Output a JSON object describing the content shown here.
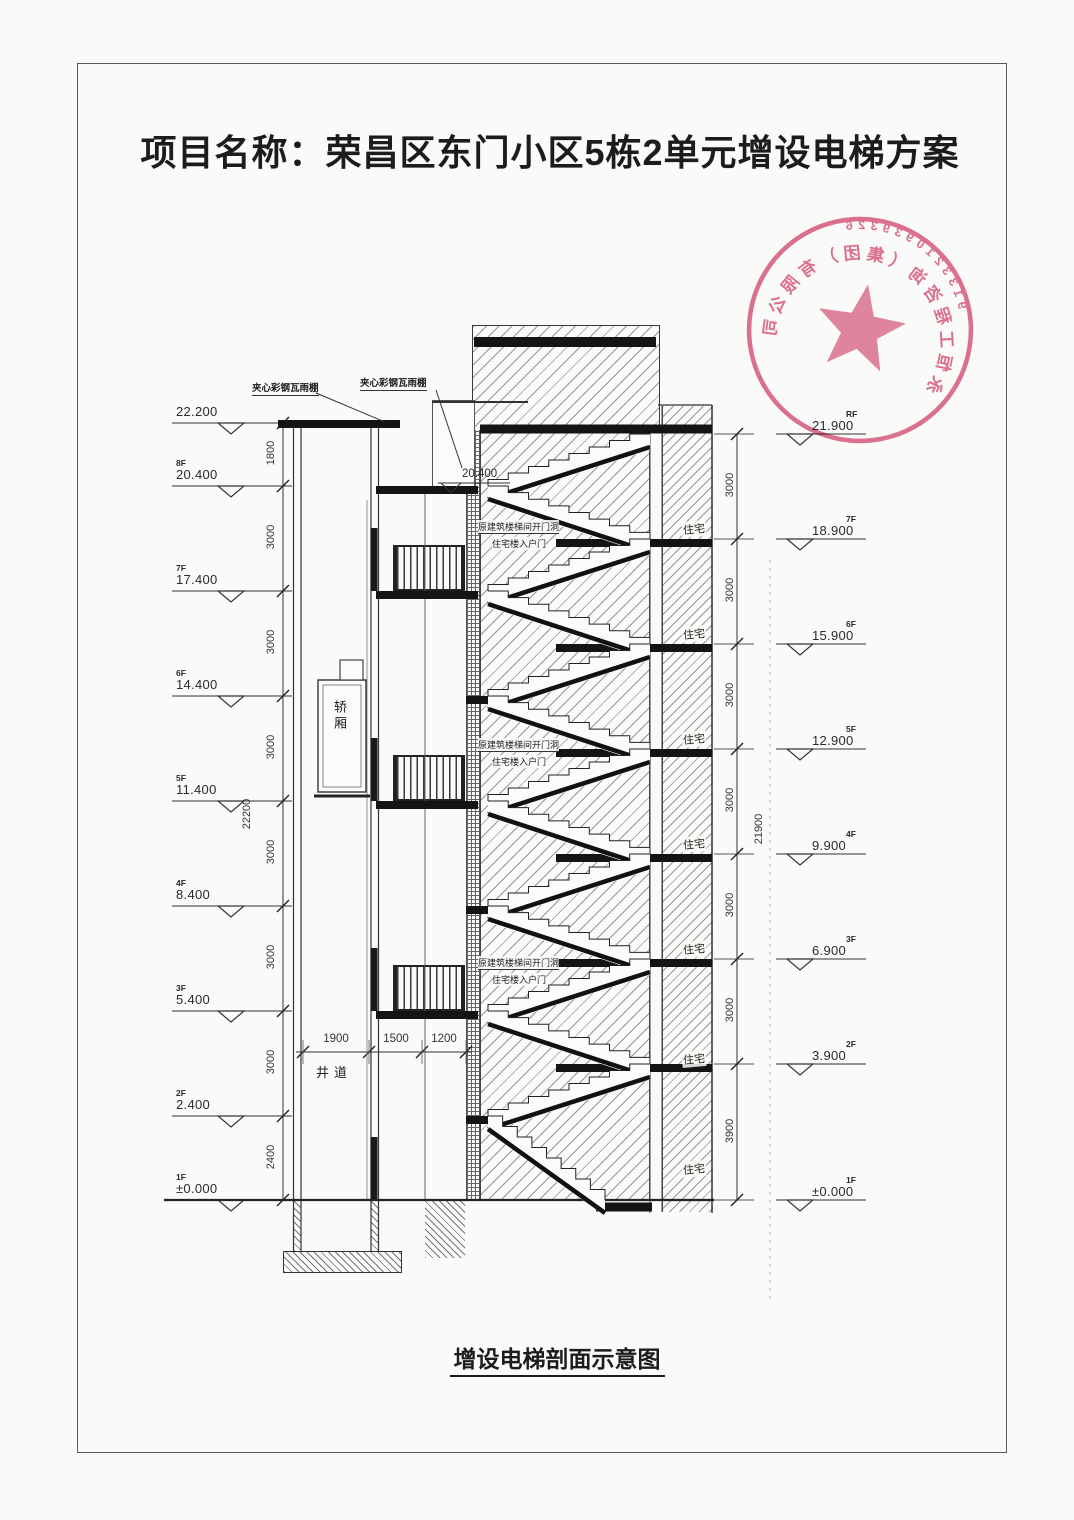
{
  "page": {
    "title": "项目名称：荣昌区东门小区5栋2单元增设电梯方案",
    "caption": "增设电梯剖面示意图"
  },
  "stamp": {
    "serial": "9133210939326",
    "company": "永恒工程咨询（集团）有限公司"
  },
  "labels": {
    "canopy_left": "夹心彩钢瓦雨棚",
    "canopy_right": "夹心彩钢瓦雨棚",
    "shaft": "井道",
    "car": "轿厢",
    "residence": "住宅",
    "stair_note_line1": "原建筑楼梯间开门洞",
    "stair_note_line2": "住宅楼入户门",
    "mid_level": "20.400"
  },
  "levels": {
    "left": [
      {
        "floor": "",
        "value": "22.200"
      },
      {
        "floor": "8F",
        "value": "20.400"
      },
      {
        "floor": "7F",
        "value": "17.400"
      },
      {
        "floor": "6F",
        "value": "14.400"
      },
      {
        "floor": "5F",
        "value": "11.400"
      },
      {
        "floor": "4F",
        "value": "8.400"
      },
      {
        "floor": "3F",
        "value": "5.400"
      },
      {
        "floor": "2F",
        "value": "2.400"
      },
      {
        "floor": "1F",
        "value": "±0.000"
      }
    ],
    "right": [
      {
        "floor": "RF",
        "value": "21.900"
      },
      {
        "floor": "7F",
        "value": "18.900"
      },
      {
        "floor": "6F",
        "value": "15.900"
      },
      {
        "floor": "5F",
        "value": "12.900"
      },
      {
        "floor": "4F",
        "value": "9.900"
      },
      {
        "floor": "3F",
        "value": "6.900"
      },
      {
        "floor": "2F",
        "value": "3.900"
      },
      {
        "floor": "1F",
        "value": "±0.000"
      }
    ]
  },
  "dimensions": {
    "left_chain": [
      "1800",
      "3000",
      "3000",
      "3000",
      "3000",
      "3000",
      "3000",
      "2400"
    ],
    "left_total": "22200",
    "right_chain": [
      "3000",
      "3000",
      "3000",
      "3000",
      "3000",
      "3000",
      "3900"
    ],
    "right_total": "21900",
    "width_chain": [
      "1900",
      "1500",
      "1200"
    ]
  }
}
